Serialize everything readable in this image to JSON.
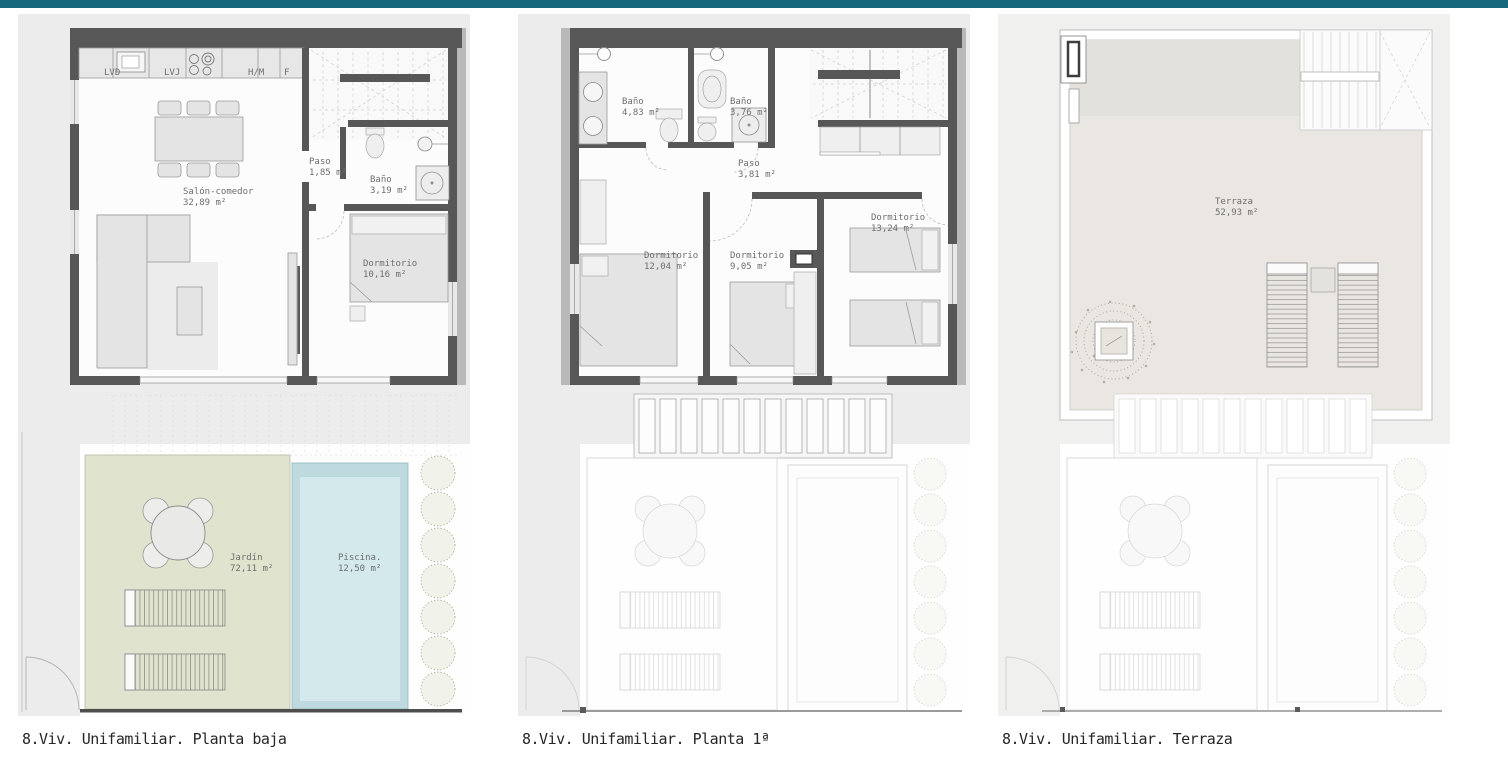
{
  "header": {
    "bar_color": "#16697c"
  },
  "colors": {
    "wall": "#575757",
    "garden_green": "#e0e3cd",
    "pool_blue": "#d3e9eb",
    "pool_border": "#bedade",
    "terrace_beige": "#eae6e1",
    "label_text": "#6e6e6e",
    "caption_text": "#262626"
  },
  "plans": [
    {
      "caption": "8.Viv. Unifamiliar. Planta baja",
      "kitchen_labels": [
        "LVD",
        "LVJ",
        "H/M",
        "F"
      ],
      "rooms": [
        {
          "name": "Salón-comedor",
          "area": "32,89 m²"
        },
        {
          "name": "Paso",
          "area": "1,85 m²"
        },
        {
          "name": "Baño",
          "area": "3,19 m²"
        },
        {
          "name": "Dormitorio",
          "area": "10,16 m²"
        },
        {
          "name": "Jardín",
          "area": "72,11 m²"
        },
        {
          "name": "Piscina.",
          "area": "12,50 m²"
        }
      ]
    },
    {
      "caption": "8.Viv. Unifamiliar. Planta 1ª",
      "rooms": [
        {
          "name": "Baño",
          "area": "4,83 m²"
        },
        {
          "name": "Baño",
          "area": "3,76 m²"
        },
        {
          "name": "Paso",
          "area": "3,81 m²"
        },
        {
          "name": "Dormitorio",
          "area": "12,04 m²"
        },
        {
          "name": "Dormitorio",
          "area": "9,05 m²"
        },
        {
          "name": "Dormitorio",
          "area": "13,24 m²"
        }
      ]
    },
    {
      "caption": "8.Viv. Unifamiliar. Terraza",
      "rooms": [
        {
          "name": "Terraza",
          "area": "52,93 m²"
        }
      ]
    }
  ]
}
